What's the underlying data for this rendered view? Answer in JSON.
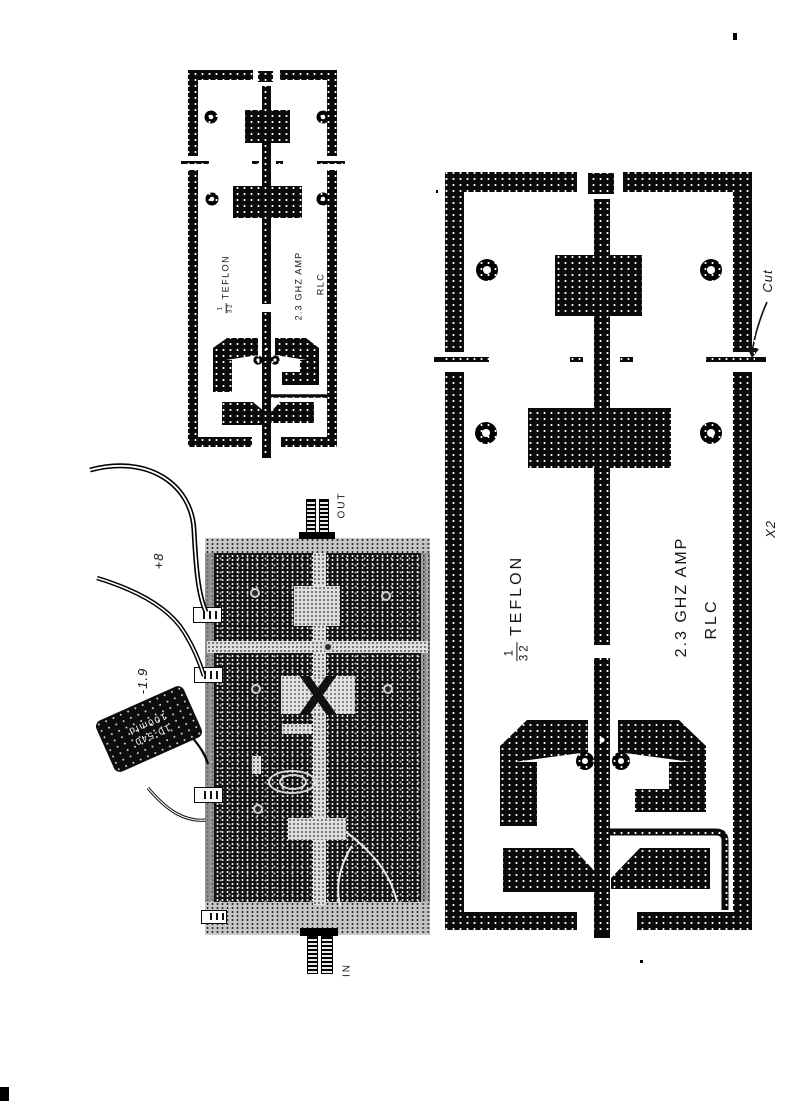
{
  "artwork": {
    "small_board": {
      "thickness_num": "1",
      "thickness_den": "32",
      "material": "TEFLON",
      "title": "2.3 GHZ AMP",
      "brand": "RLC"
    },
    "large_board": {
      "thickness_num": "1",
      "thickness_den": "32",
      "material": "TEFLON",
      "title": "2.3 GHZ AMP",
      "brand": "RLC",
      "quantity_note": "X2",
      "cut_note": "Cut"
    },
    "photo": {
      "out_label": "OUT",
      "in_label": "IN",
      "supply_pos": "+8",
      "supply_neg": "-1.9",
      "cap_line1": "10-540",
      "cap_line2": "100mfd"
    }
  }
}
